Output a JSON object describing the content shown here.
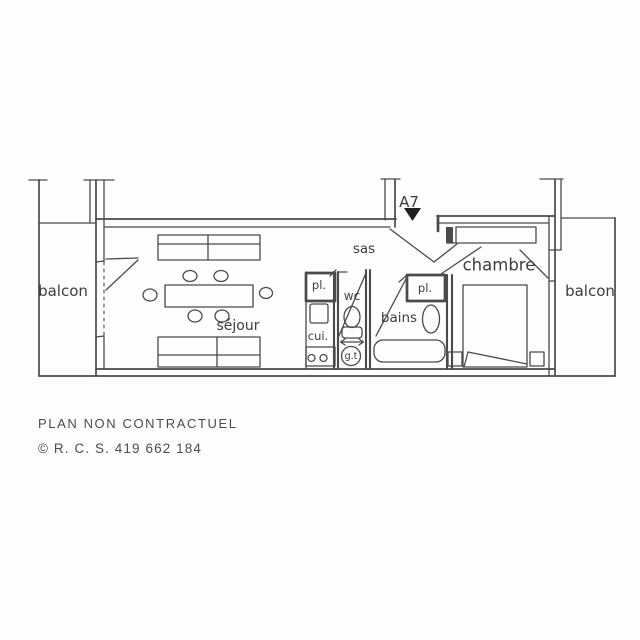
{
  "colors": {
    "ink": "#4a4a4a",
    "label": "#3d3d3d",
    "arrow_fill": "#1f1f1f",
    "paper": "#fffefe"
  },
  "apartment": {
    "unit_label": "A7"
  },
  "rooms": {
    "balcon_left": "balcon",
    "sejour": "séjour",
    "sas": "sas",
    "placard_cuisine": "pl.",
    "cuisine": "cui.",
    "wc": "wc",
    "gaine_technique": "g.t",
    "bains": "bains",
    "placard_bains": "pl.",
    "chambre": "chambre",
    "balcon_right": "balcon"
  },
  "footer": {
    "disclaimer": "PLAN NON CONTRACTUEL",
    "registration": "© R. C. S. 419 662 184"
  }
}
